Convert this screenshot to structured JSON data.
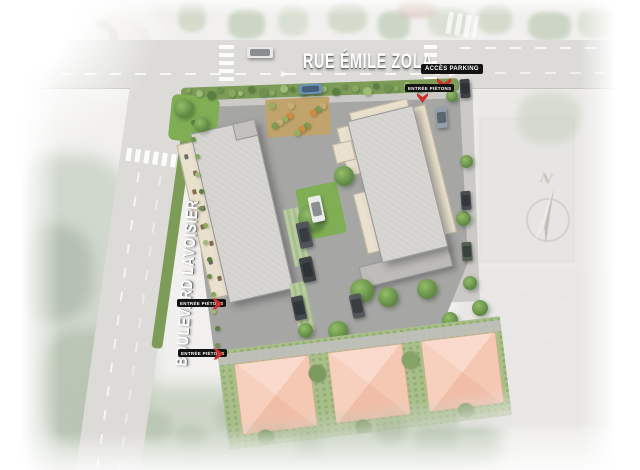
{
  "annotations": {
    "street_top": "RUE ÉMILE ZOLA",
    "street_left": "BOULEVARD LAVOISIER",
    "acces_parking": "ACCÈS PARKING",
    "entree_pietons_top": "ENTRÉE PIÉTONS",
    "entree_pietons_west_upper": "ENTRÉE PIÉTONS",
    "entree_pietons_west_lower": "ENTRÉE PIÉTONS",
    "north": "N"
  },
  "colors": {
    "marker_red": "#cf2f28",
    "annotation_bg": "#131313",
    "annotation_text": "#ffffff",
    "street_text": "#ffffff",
    "road_gray": "#dcdbd8",
    "roof_gray": "#d3d2ce",
    "roof_salmon": "#f6cab6",
    "hedge_green": "#7c9c58",
    "grass_green": "#7fae55"
  }
}
